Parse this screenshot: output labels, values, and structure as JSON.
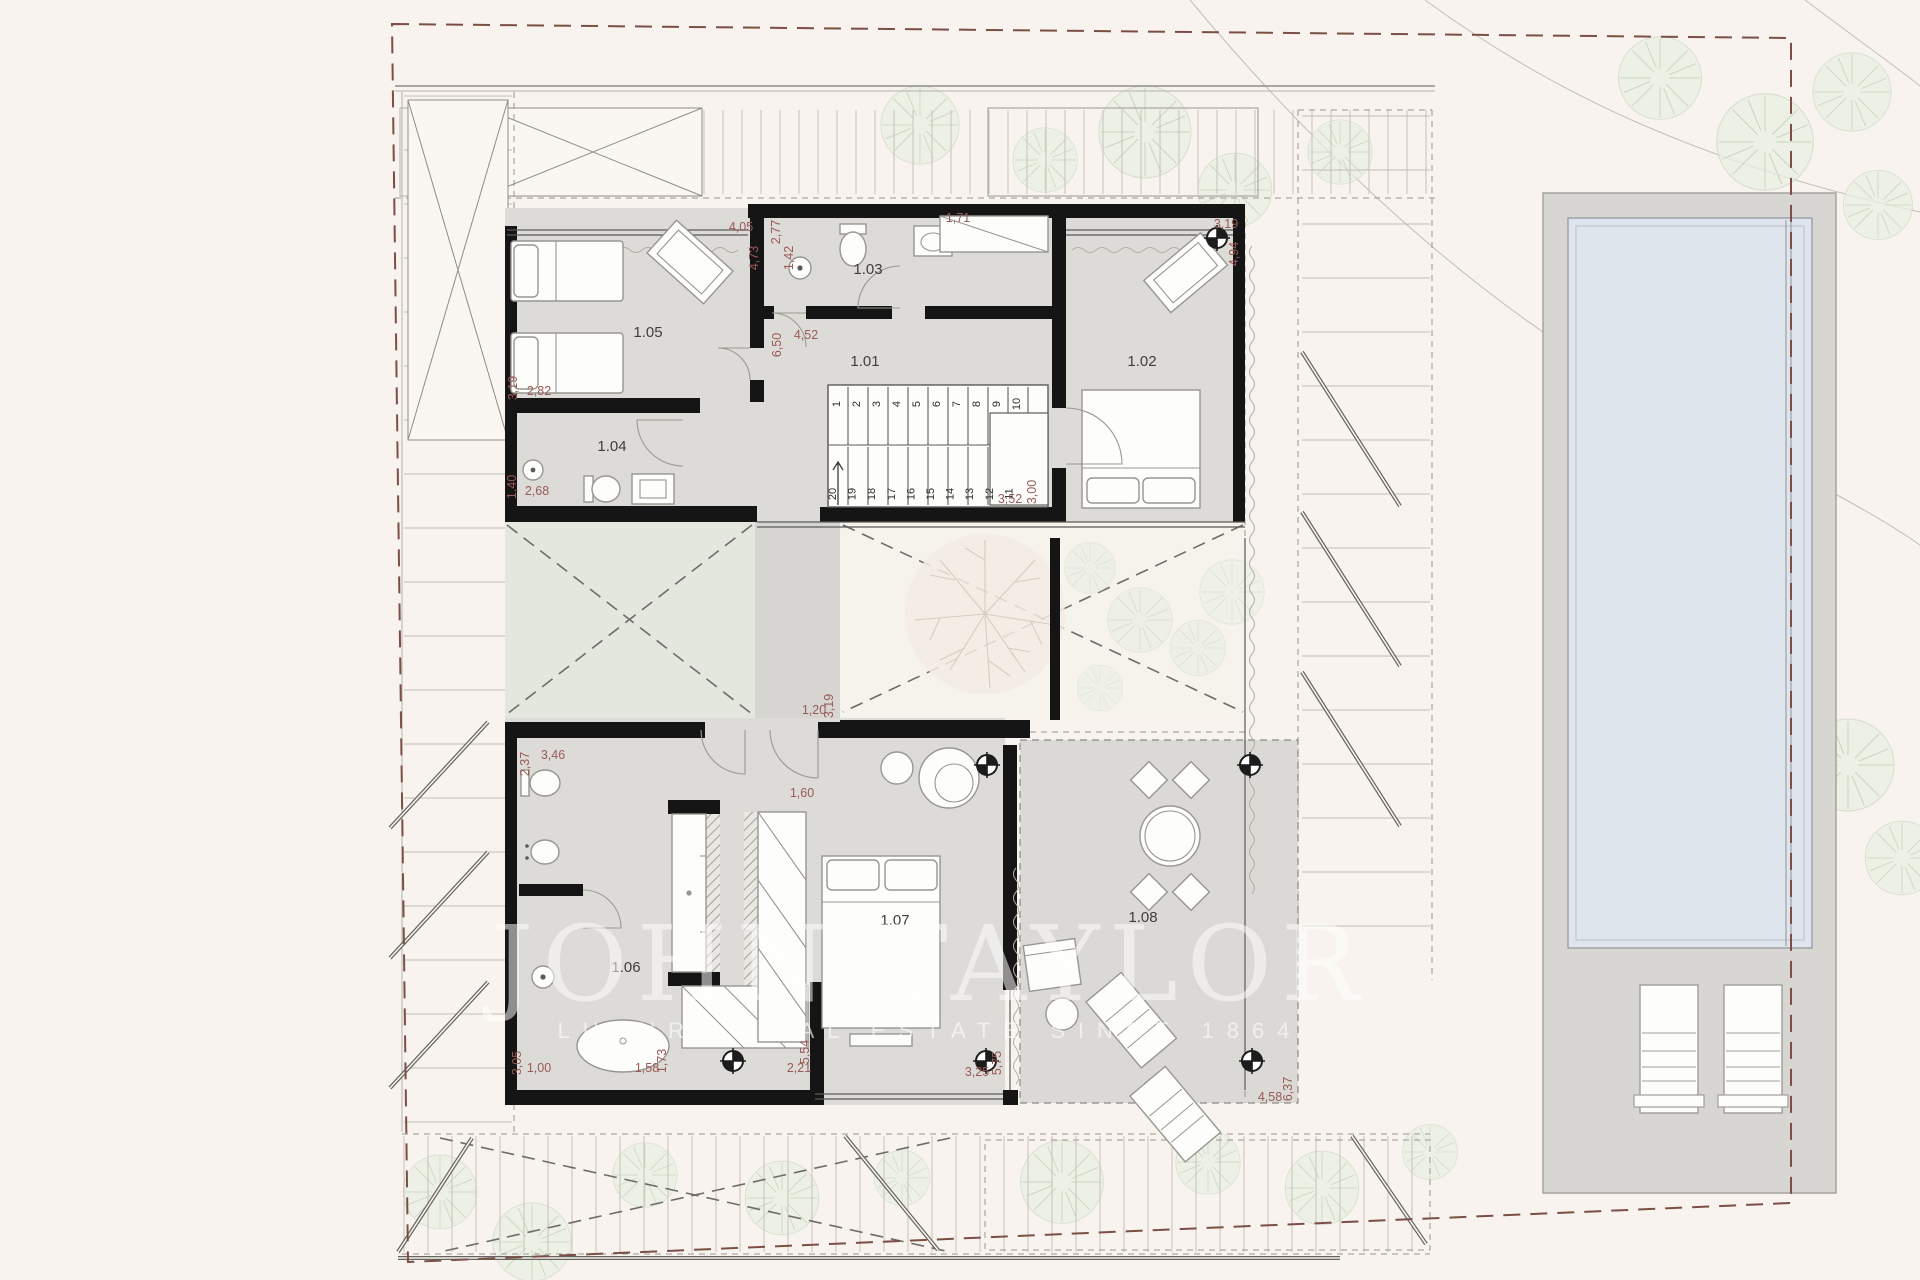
{
  "plan": {
    "watermark": {
      "title": "JOHN TAYLOR",
      "subtitle": "LUXURY REAL ESTATE SINCE 1864"
    },
    "room_labels": [
      {
        "label": "1.01",
        "x": 865,
        "y": 366
      },
      {
        "label": "1.02",
        "x": 1142,
        "y": 366
      },
      {
        "label": "1.03",
        "x": 868,
        "y": 274
      },
      {
        "label": "1.04",
        "x": 612,
        "y": 451
      },
      {
        "label": "1.05",
        "x": 648,
        "y": 337
      },
      {
        "label": "1.06",
        "x": 626,
        "y": 972
      },
      {
        "label": "1.07",
        "x": 895,
        "y": 925
      },
      {
        "label": "1.08",
        "x": 1143,
        "y": 922
      }
    ],
    "dimensions": [
      {
        "t": "4,05",
        "x": 741,
        "y": 231,
        "r": 0
      },
      {
        "t": "4,73",
        "x": 758,
        "y": 258,
        "r": -90
      },
      {
        "t": "2,77",
        "x": 780,
        "y": 232,
        "r": -90
      },
      {
        "t": "1,42",
        "x": 793,
        "y": 258,
        "r": -90
      },
      {
        "t": "1,71",
        "x": 958,
        "y": 222,
        "r": 0
      },
      {
        "t": "3,19",
        "x": 1226,
        "y": 228,
        "r": 0
      },
      {
        "t": "4,94",
        "x": 1238,
        "y": 254,
        "r": -90
      },
      {
        "t": "6,50",
        "x": 781,
        "y": 345,
        "r": -90
      },
      {
        "t": "4,52",
        "x": 806,
        "y": 339,
        "r": 0
      },
      {
        "t": "3,19",
        "x": 517,
        "y": 388,
        "r": -90
      },
      {
        "t": "2,82",
        "x": 539,
        "y": 395,
        "r": 0
      },
      {
        "t": "1,40",
        "x": 516,
        "y": 487,
        "r": -90
      },
      {
        "t": "2,68",
        "x": 537,
        "y": 495,
        "r": 0
      },
      {
        "t": "3,52",
        "x": 1010,
        "y": 503,
        "r": 0
      },
      {
        "t": "3,00",
        "x": 1036,
        "y": 492,
        "r": -90
      },
      {
        "t": "1,20",
        "x": 814,
        "y": 714,
        "r": 0
      },
      {
        "t": "3,19",
        "x": 833,
        "y": 706,
        "r": -90
      },
      {
        "t": "1,60",
        "x": 802,
        "y": 797,
        "r": 0
      },
      {
        "t": "2,37",
        "x": 529,
        "y": 764,
        "r": -90
      },
      {
        "t": "3,46",
        "x": 553,
        "y": 759,
        "r": 0
      },
      {
        "t": "3,05",
        "x": 521,
        "y": 1063,
        "r": -90
      },
      {
        "t": "1,00",
        "x": 539,
        "y": 1072,
        "r": 0
      },
      {
        "t": "1,58",
        "x": 647,
        "y": 1072,
        "r": 0
      },
      {
        "t": "1,73",
        "x": 666,
        "y": 1061,
        "r": -90
      },
      {
        "t": "5,54",
        "x": 809,
        "y": 1052,
        "r": -90
      },
      {
        "t": "2,21",
        "x": 799,
        "y": 1072,
        "r": 0
      },
      {
        "t": "3,25",
        "x": 977,
        "y": 1076,
        "r": 0
      },
      {
        "t": "5,75",
        "x": 1001,
        "y": 1063,
        "r": -90
      },
      {
        "t": "4,58",
        "x": 1270,
        "y": 1101,
        "r": 0
      },
      {
        "t": "6,37",
        "x": 1292,
        "y": 1089,
        "r": -90
      }
    ],
    "stairs": {
      "up": [
        "1",
        "2",
        "3",
        "4",
        "5",
        "6",
        "7",
        "8",
        "9",
        "10"
      ],
      "down": [
        "20",
        "19",
        "18",
        "17",
        "16",
        "15",
        "14",
        "13",
        "12",
        "11"
      ]
    },
    "colors": {
      "background": "#f8f3ee",
      "room_fill": "#dcdbd8",
      "courtyard_green": "#e3e7de",
      "pool_water": "#dfe5ec",
      "pool_deck": "#d8d6d2",
      "wall": "#151515",
      "dimension_text": "#9a5a56",
      "boundary_dash": "#7b4f45",
      "watermark": "#ffffff"
    }
  }
}
